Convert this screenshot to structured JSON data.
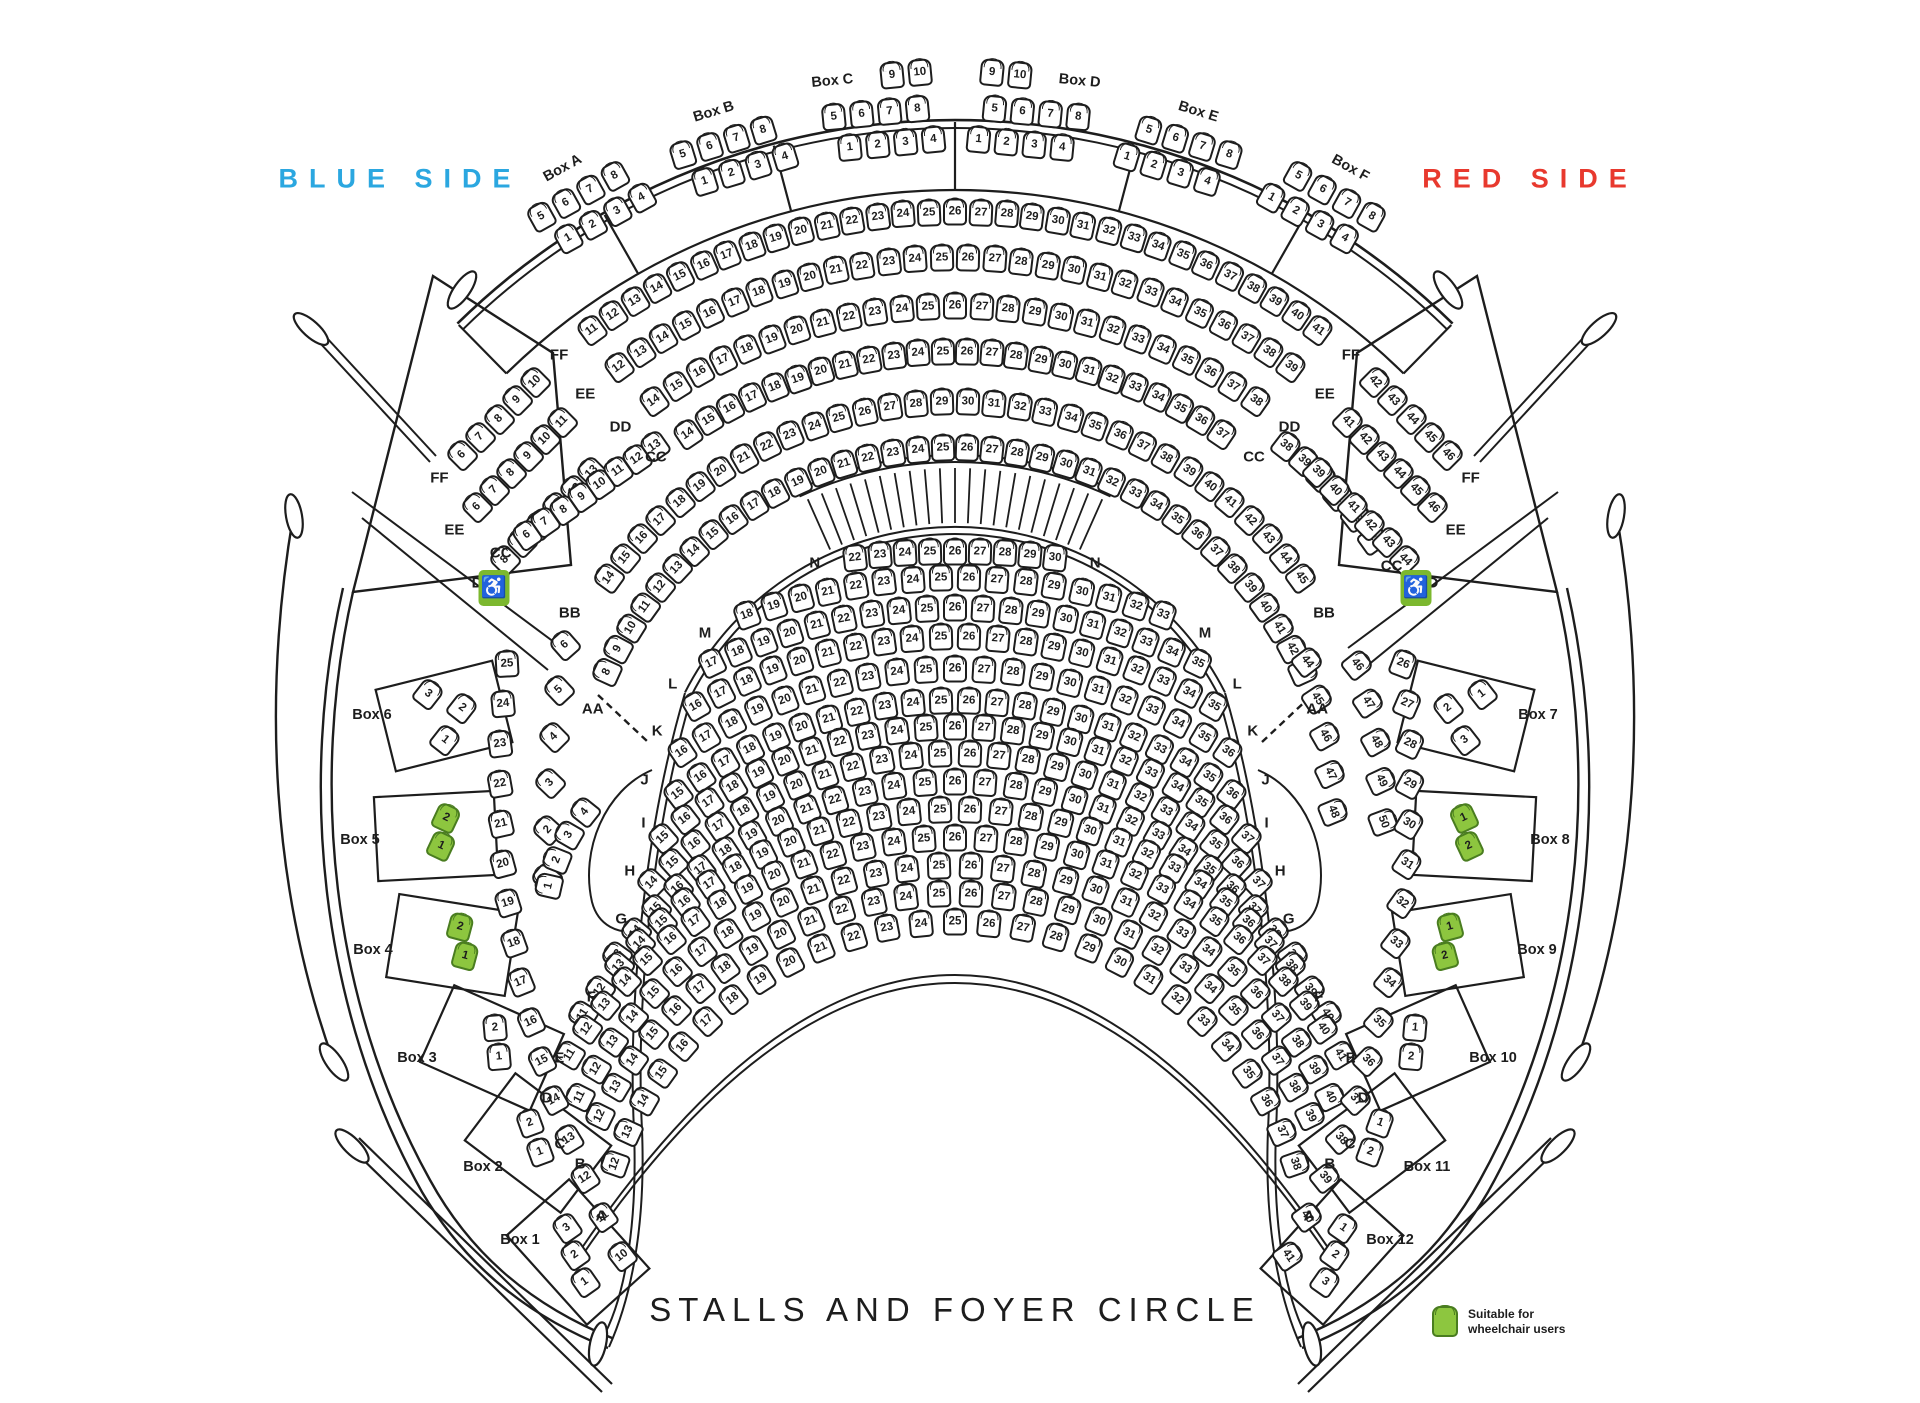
{
  "title": "STALLS AND FOYER CIRCLE",
  "sides": {
    "left": "BLUE SIDE",
    "right": "RED SIDE"
  },
  "colors": {
    "blue": "#2ba7e0",
    "red": "#e8392e",
    "green": "#8dc63f",
    "green_border": "#4a7d20",
    "line": "#1d1d1d"
  },
  "legend": {
    "line1": "Suitable for",
    "line2": "wheelchair users"
  },
  "icons": {
    "wheelchair": "♿"
  },
  "stalls_rows": [
    {
      "label": "N",
      "from": 22,
      "to": 30
    },
    {
      "label": "M",
      "from": 18,
      "to": 33
    },
    {
      "label": "L",
      "from": 17,
      "to": 35
    },
    {
      "label": "K",
      "from": 16,
      "to": 35
    },
    {
      "label": "J",
      "from": 16,
      "to": 36
    },
    {
      "label": "I",
      "from": 15,
      "to": 36
    },
    {
      "label": "H",
      "from": 15,
      "to": 37
    },
    {
      "label": "G",
      "from": 14,
      "to": 37
    },
    {
      "label": "F",
      "from": 13,
      "to": 39
    },
    {
      "label": "E",
      "from": 11,
      "to": 40
    },
    {
      "label": "D",
      "from": 11,
      "to": 41
    },
    {
      "label": "C",
      "from": 11,
      "to": 40
    },
    {
      "label": "B",
      "from": 12,
      "to": 39
    },
    {
      "label": "A",
      "from": 12,
      "to": 38
    }
  ],
  "circle_strips": [
    {
      "id": "ff_wing_l",
      "row": "FF",
      "from": 6,
      "to": 10,
      "label_start": true
    },
    {
      "id": "ee_wing_l",
      "row": "EE",
      "from": 6,
      "to": 11,
      "label_start": true
    },
    {
      "id": "dd_wing_l",
      "row": "DD",
      "from": 8,
      "to": 13,
      "label_start": true
    },
    {
      "id": "ff_main",
      "row": "FF",
      "from": 11,
      "to": 41,
      "label_start": true,
      "label_end": true
    },
    {
      "id": "ee_main",
      "row": "EE",
      "from": 12,
      "to": 39,
      "label_start": true,
      "label_end": true
    },
    {
      "id": "dd_main",
      "row": "DD",
      "from": 14,
      "to": 38,
      "label_start": true,
      "label_end": true
    },
    {
      "id": "cc_head",
      "row": "CC",
      "from": 6,
      "to": 13,
      "label_start": true
    },
    {
      "id": "cc_main",
      "row": "CC",
      "from": 14,
      "to": 37,
      "label_start": true,
      "label_end": true
    },
    {
      "id": "cc_tail",
      "row": "CC",
      "from": 38,
      "to": 43,
      "label_end": true
    },
    {
      "id": "bb_head",
      "row": "BB",
      "from": 6,
      "to": 1,
      "label_start": true
    },
    {
      "id": "bb_main",
      "row": "BB",
      "from": 14,
      "to": 45,
      "label_end": true
    },
    {
      "id": "bb_tail",
      "row": "BB",
      "from": 46,
      "to": 50
    },
    {
      "id": "aa_pocket",
      "row": "AA",
      "from": 1,
      "to": 4
    },
    {
      "id": "aa_main",
      "row": "AA",
      "from": 8,
      "to": 43,
      "label_start": true,
      "label_end": true
    },
    {
      "id": "aa_tail",
      "row": "AA",
      "from": 44,
      "to": 48
    },
    {
      "id": "slips_l",
      "row": "slips",
      "from": 25,
      "to": 10
    },
    {
      "id": "slips_r",
      "row": "slips",
      "from": 26,
      "to": 41
    },
    {
      "id": "ff_wing_r",
      "row": "FF",
      "from": 42,
      "to": 46,
      "label_end": true
    },
    {
      "id": "ee_wing_r",
      "row": "EE",
      "from": 41,
      "to": 46,
      "label_end": true
    },
    {
      "id": "dd_wing_r",
      "row": "DD",
      "from": 39,
      "to": 44,
      "label_end": true
    }
  ],
  "top_boxes": [
    {
      "name": "Box A",
      "rows": [
        [
          5,
          6,
          7,
          8
        ],
        [
          1,
          2,
          3,
          4
        ]
      ]
    },
    {
      "name": "Box B",
      "rows": [
        [
          5,
          6,
          7,
          8
        ],
        [
          1,
          2,
          3,
          4
        ]
      ]
    },
    {
      "name": "Box C",
      "rows": [
        [
          9,
          10
        ],
        [
          5,
          6,
          7,
          8
        ],
        [
          1,
          2,
          3,
          4
        ]
      ]
    },
    {
      "name": "Box D",
      "rows": [
        [
          9,
          10
        ],
        [
          5,
          6,
          7,
          8
        ],
        [
          1,
          2,
          3,
          4
        ]
      ]
    },
    {
      "name": "Box E",
      "rows": [
        [
          5,
          6,
          7,
          8
        ],
        [
          1,
          2,
          3,
          4
        ]
      ]
    },
    {
      "name": "Box F",
      "rows": [
        [
          5,
          6,
          7,
          8
        ],
        [
          1,
          2,
          3,
          4
        ]
      ]
    }
  ],
  "side_boxes": [
    {
      "name": "Box 6",
      "seats": [
        3,
        2,
        1
      ],
      "green": false
    },
    {
      "name": "Box 5",
      "seats": [
        2,
        1
      ],
      "green": true
    },
    {
      "name": "Box 4",
      "seats": [
        2,
        1
      ],
      "green": true
    },
    {
      "name": "Box 3",
      "seats": [
        2,
        1
      ],
      "green": false
    },
    {
      "name": "Box 2",
      "seats": [
        2,
        1
      ],
      "green": false
    },
    {
      "name": "Box 1",
      "seats": [
        3,
        2,
        1
      ],
      "green": false
    },
    {
      "name": "Box 7",
      "seats": [
        1,
        2,
        3
      ],
      "green": false
    },
    {
      "name": "Box 8",
      "seats": [
        1,
        2
      ],
      "green": true
    },
    {
      "name": "Box 9",
      "seats": [
        1,
        2
      ],
      "green": true
    },
    {
      "name": "Box 10",
      "seats": [
        1,
        2
      ],
      "green": false
    },
    {
      "name": "Box 11",
      "seats": [
        1,
        2
      ],
      "green": false
    },
    {
      "name": "Box 12",
      "seats": [
        1,
        2,
        3
      ],
      "green": false
    }
  ]
}
